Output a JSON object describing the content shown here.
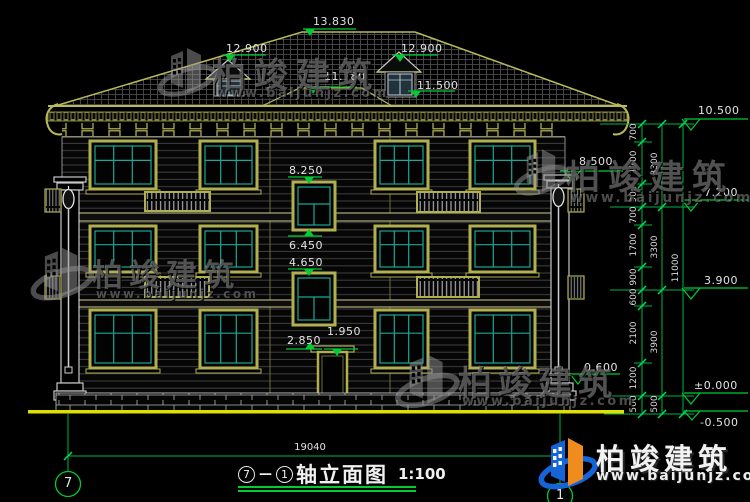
{
  "drawing": {
    "title": {
      "axis_start": "7",
      "dash": "—",
      "axis_end": "1",
      "name": "轴立面图",
      "scale": "1:100"
    },
    "total_width_dim": "19040",
    "axis_bubbles": {
      "left": "7",
      "right": "1"
    },
    "facade_levels": {
      "ridge": "13.830",
      "dormer_left_top": "12.900",
      "dormer_right_top": "12.900",
      "bay_roof": "11.780",
      "dormer_right_sill": "11.500",
      "pier_capital": "8.500",
      "stair_window_top": "8.250",
      "stair_window_sill": "6.450",
      "stair_window2_top": "4.650",
      "entry_transom": "2.850",
      "door_head": "1.950",
      "base_top": "0.600"
    },
    "right_levels": [
      "10.500",
      "7.200",
      "3.900",
      "±0.000",
      "-0.500"
    ],
    "dim_chain_inner": [
      "700",
      "1700",
      "900",
      "700",
      "1700",
      "900",
      "600",
      "2100",
      "1200",
      "500"
    ],
    "dim_chain_middle": [
      "3300",
      "3300",
      "3900",
      "500"
    ],
    "dim_chain_outer": [
      "11000"
    ]
  },
  "branding": {
    "name": "柏竣建筑",
    "url": "www.baijunjz.com"
  },
  "colors": {
    "cad_green": "#00cc33",
    "cad_yellow": "#b9b95a",
    "window_teal": "#1ba896",
    "ground_yellow": "#e0e000",
    "logo_blue": "#1565d8",
    "logo_orange": "#f08c1e"
  }
}
